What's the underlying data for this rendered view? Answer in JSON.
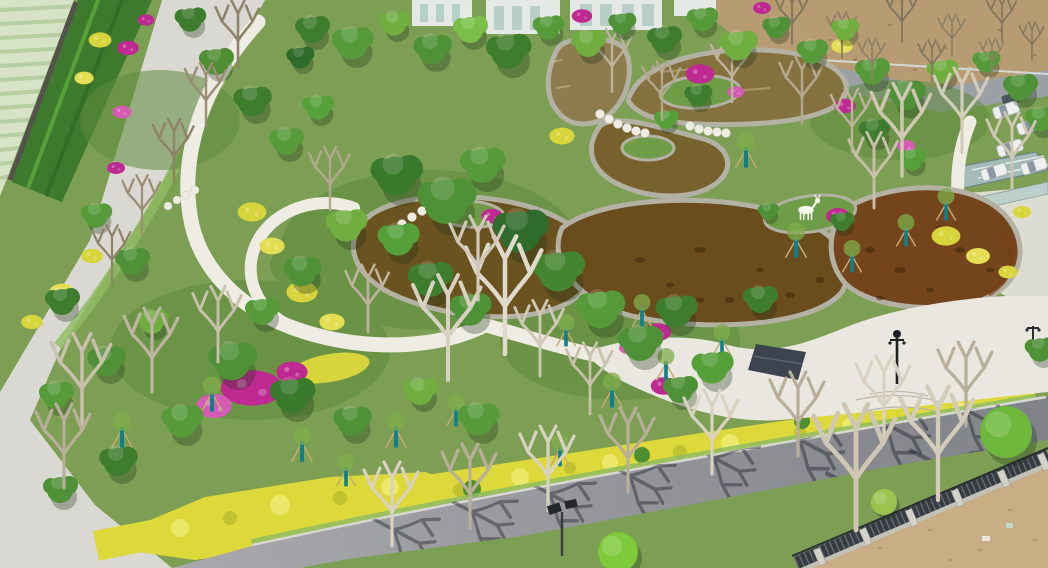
{
  "image": {
    "width": 1048,
    "height": 568,
    "kind": "aerial drone photograph",
    "description": "Aerial view of a newly landscaped park: a terraced amber-water pond with stone edging, white looping footpaths, magenta azalea and golden hedge beds, staked young trees, a white plaza, perimeter roads, a boundary fence and farm fields"
  },
  "palette": {
    "base-green": "#7c9f54",
    "grass-dark": "#5e8a3c",
    "lawn-bright": "#8fbc62",
    "farm-light": "#d6e3c6",
    "farm-stripe": "#b7cda2",
    "road-left": "#d9d8d2",
    "path-white": "#efece4",
    "plaza": "#e9e7df",
    "pave-right": "#e0e0d7",
    "asphalt-light": "#a9a9ad",
    "asphalt-dark": "#7f8287",
    "curb": "#d8d8d2",
    "water-1": "#8d7c4e",
    "water-2": "#84713d",
    "water-3": "#77622e",
    "water-4": "#6b531f",
    "water-5": "#6b4d1d",
    "water-6": "#74451c",
    "stone": "#b3b1a4",
    "island-green": "#6f9c46",
    "hedge-yellow": "#ddd93a",
    "hedge-yellow-light": "#ece96a",
    "hedge-dapple": "#c0c22f",
    "magenta": "#bf2a92",
    "magenta-light": "#d55cb5",
    "shrub-dark": "#2f6b2a",
    "shrub-mid": "#4e9136",
    "shrub-light": "#7bbf48",
    "field-brown": "#b69b73",
    "dirt": "#c9ad85",
    "fence-dark": "#363c42",
    "fence-base": "#c2c1b8",
    "fence-post": "#d2d2c8",
    "teal-guard": "#0f7f8a",
    "stake-wood": "#c8a96f",
    "branch-white": "#d9d2c2",
    "branch-brown": "#9a8d77",
    "building": "#e4e9e5",
    "glass": "#b7cec9",
    "canopy-teal": "#a3bcb8",
    "car-white": "#eef0ee",
    "lamp-dark": "#2a2d31",
    "shadow": "rgba(28,30,44,0.42)"
  },
  "scene": {
    "objects": [
      {
        "name": "farmland fields with plastic-covered crop rows"
      },
      {
        "name": "boundary wall with terraced hedge planters and magenta bougainvillea"
      },
      {
        "name": "west perimeter concrete road",
        "color": "#d9d8d2"
      },
      {
        "name": "park lawns and mixed shrub gardens"
      },
      {
        "name": "terraced ornamental pond with amber water and stone edging",
        "color": "#6b531f"
      },
      {
        "name": "stepping-stone crossings over the pond"
      },
      {
        "name": "white deer sculpture on pond peninsula",
        "color": "#f6f6ef"
      },
      {
        "name": "white paved plaza",
        "color": "#e9e7df"
      },
      {
        "name": "dark shade pavilion at plaza edge"
      },
      {
        "name": "ornate plaza lamp post"
      },
      {
        "name": "white looping footpaths",
        "color": "#efece4"
      },
      {
        "name": "golden privet hedge bands",
        "color": "#ddd93a"
      },
      {
        "name": "magenta azalea and bougainvillea beds",
        "color": "#bf2a92"
      },
      {
        "name": "young staked trees with teal trunk guards",
        "color": "#0f7f8a"
      },
      {
        "name": "southern asphalt road with bare-tree shadows",
        "color": "#8f9094"
      },
      {
        "name": "solar street lamp"
      },
      {
        "name": "south-east boundary fence with concrete posts"
      },
      {
        "name": "bare earth lot beyond the fence",
        "color": "#c9ad85"
      },
      {
        "name": "parked cars along the north-east road",
        "color": "#eef0ee"
      },
      {
        "name": "glass canopy shelter",
        "color": "#a3bcb8"
      },
      {
        "name": "white buildings at the north edge",
        "color": "#e4e9e5"
      },
      {
        "name": "ploughed brown field to the north-east",
        "color": "#b69b73"
      },
      {
        "name": "bare deciduous trees and green canopies"
      }
    ]
  }
}
